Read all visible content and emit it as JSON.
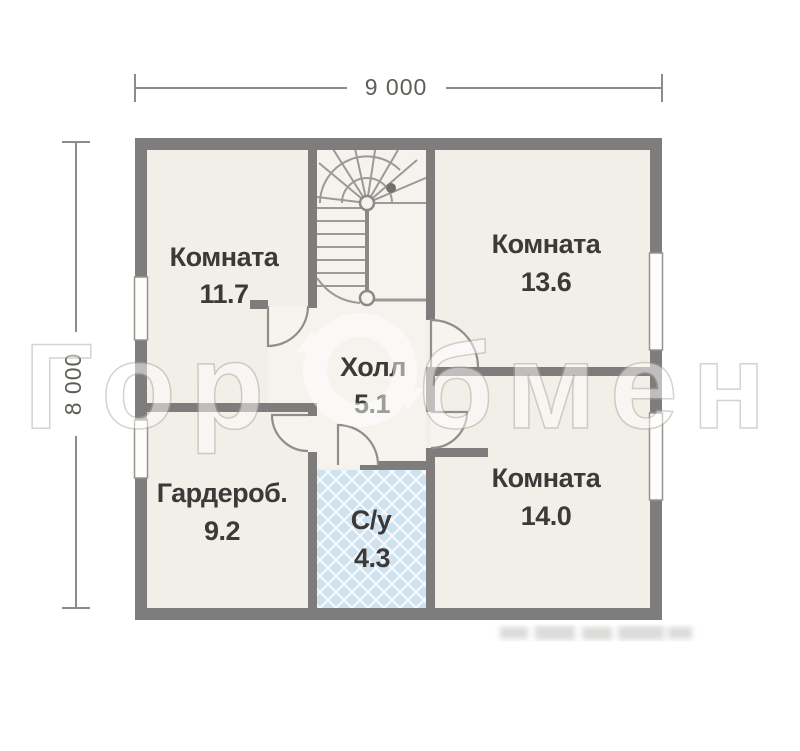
{
  "dimensions": {
    "width_label": "9 000",
    "height_label": "8 000"
  },
  "rooms": {
    "room_11_7": {
      "label": "Комната",
      "area": "11.7"
    },
    "room_13_6": {
      "label": "Комната",
      "area": "13.6"
    },
    "hall": {
      "label": "Холл",
      "area": "5.1"
    },
    "wardrobe": {
      "label": "Гардероб.",
      "area": "9.2"
    },
    "bathroom": {
      "label": "С/у",
      "area": "4.3"
    },
    "room_14_0": {
      "label": "Комната",
      "area": "14.0"
    }
  },
  "watermark": {
    "left": "Гор",
    "right": "бмен"
  },
  "colors": {
    "wall": "#7e7d7b",
    "floor": "#f2eee8",
    "floor_light": "#f6f3ef",
    "door_fill": "#f7f4ef",
    "tile_blue": "#cfe2ef",
    "label_text": "#3b3a38",
    "dimension_text": "#5f5e59"
  }
}
